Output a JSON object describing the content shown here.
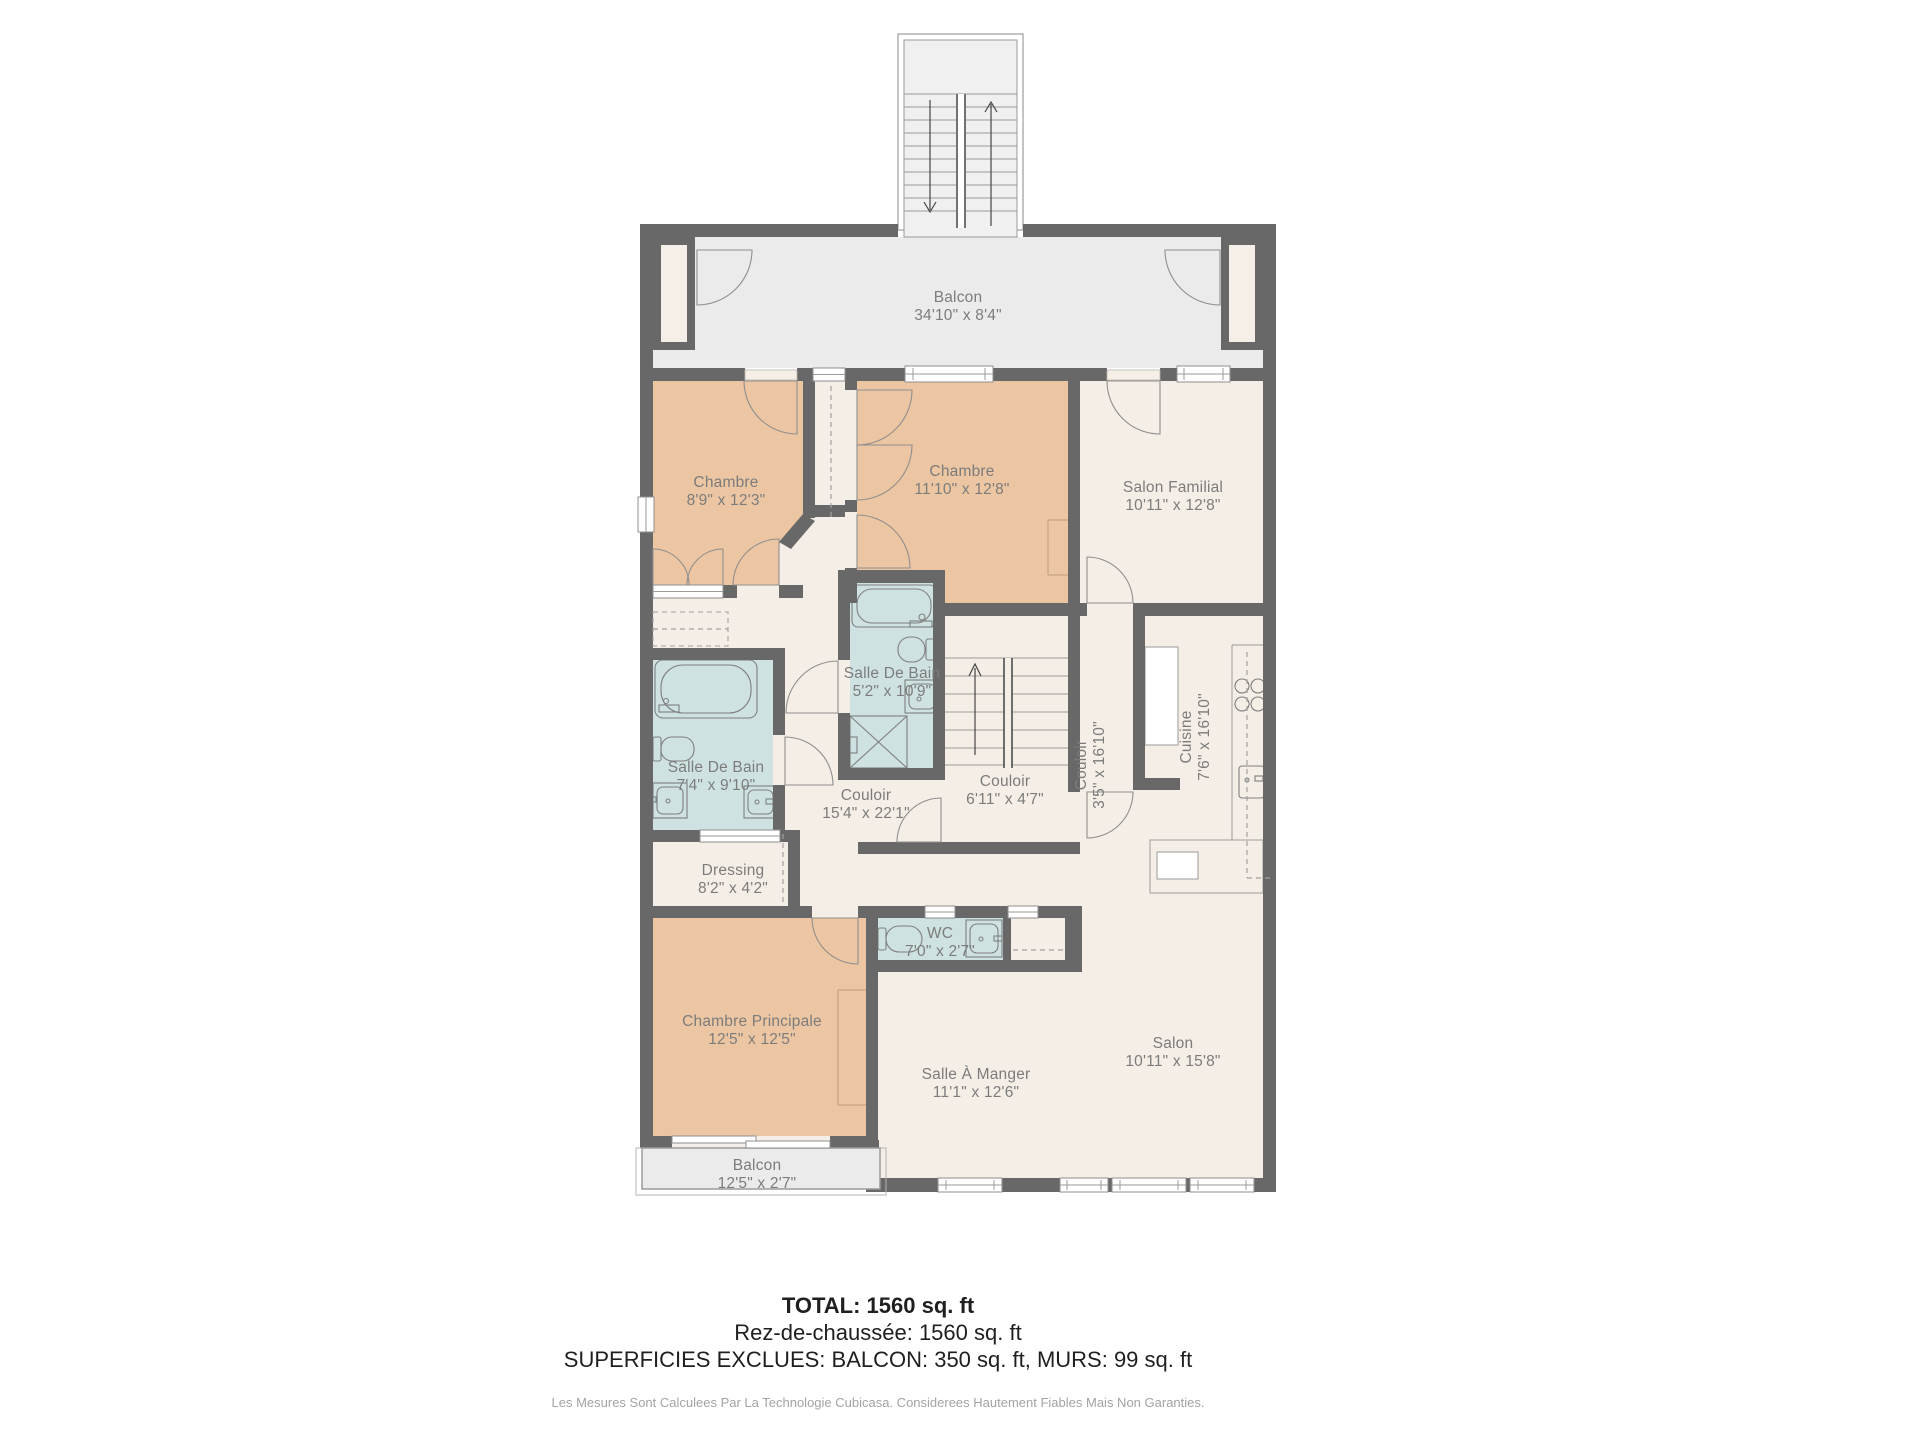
{
  "floor_plan": {
    "rooms": {
      "balcon_top": {
        "name": "Balcon",
        "dims": "34'10\" x 8'4\""
      },
      "chambre_gauche": {
        "name": "Chambre",
        "dims": "8'9\" x 12'3\""
      },
      "chambre_milieu": {
        "name": "Chambre",
        "dims": "11'10\" x 12'8\""
      },
      "salon_familial": {
        "name": "Salon Familial",
        "dims": "10'11\" x 12'8\""
      },
      "salle_de_bain_haut": {
        "name": "Salle De Bain",
        "dims": "5'2\" x 10'9\""
      },
      "salle_de_bain_gauche": {
        "name": "Salle De Bain",
        "dims": "7'4\" x 9'10\""
      },
      "couloir_principal": {
        "name": "Couloir",
        "dims": "15'4\" x 22'1\""
      },
      "couloir_centre": {
        "name": "Couloir",
        "dims": "6'11\" x 4'7\""
      },
      "couloir_vertical": {
        "name": "Couloir",
        "dims": "3'5\" x 16'10\""
      },
      "cuisine": {
        "name": "Cuisine",
        "dims": "7'6\" x 16'10\""
      },
      "dressing": {
        "name": "Dressing",
        "dims": "8'2\" x 4'2\""
      },
      "wc": {
        "name": "WC",
        "dims": "7'0\" x 2'7\""
      },
      "chambre_principale": {
        "name": "Chambre Principale",
        "dims": "12'5\" x 12'5\""
      },
      "salle_a_manger": {
        "name": "Salle À Manger",
        "dims": "11'1\" x 12'6\""
      },
      "salon": {
        "name": "Salon",
        "dims": "10'11\" x 15'8\""
      },
      "balcon_bas": {
        "name": "Balcon",
        "dims": "12'5\" x 2'7\""
      }
    },
    "summary": {
      "total": "TOTAL: 1560 sq. ft",
      "floor_line": "Rez-de-chaussée: 1560 sq. ft",
      "exclusions": "SUPERFICIES EXCLUES: BALCON: 350 sq. ft, MURS: 99 sq. ft",
      "disclaimer": "Les Mesures Sont Calculees Par La Technologie Cubicasa. Considerees Hautement Fiables Mais Non Garanties."
    },
    "colors": {
      "wall": "#686868",
      "room_beige": "#f5eee7",
      "room_orange": "#ecc6a2",
      "room_blue": "#cfe2e2",
      "balcony_gray": "#ebebeb",
      "label_text": "#7c7c7c"
    }
  }
}
